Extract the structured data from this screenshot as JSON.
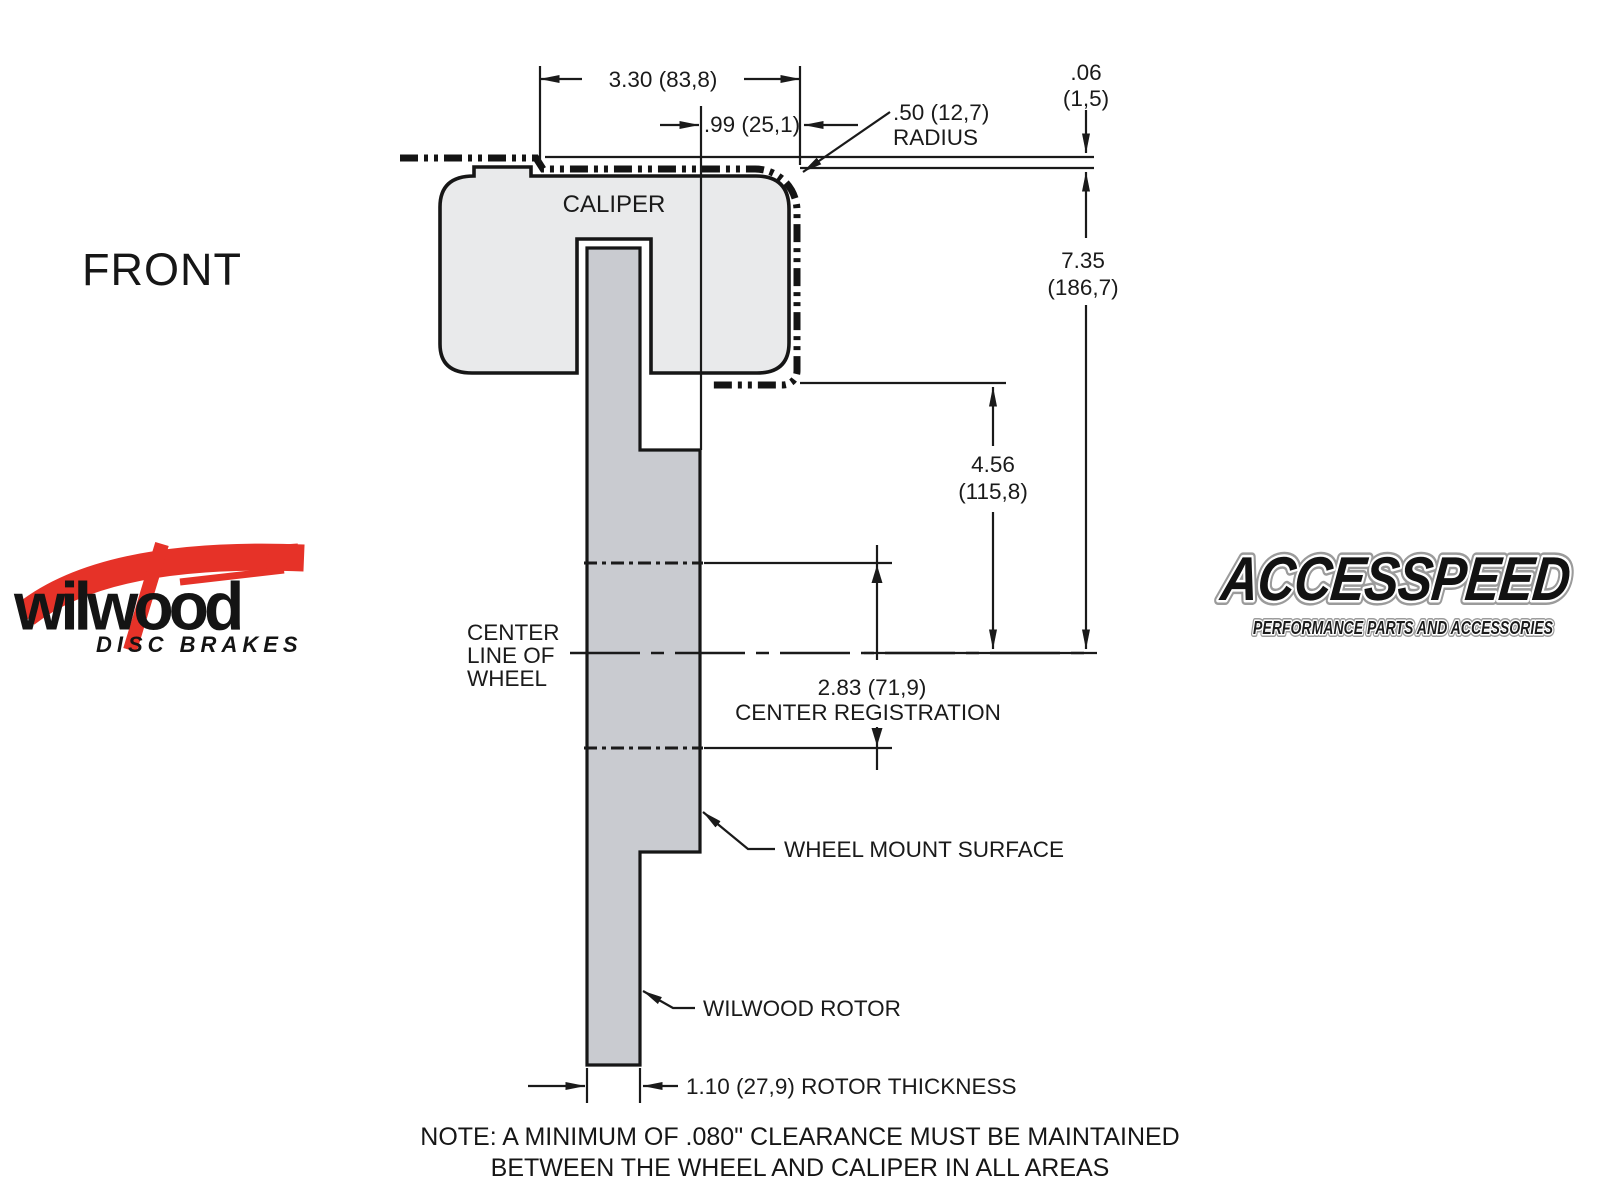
{
  "view_label": "FRONT",
  "caliper_label": "CALIPER",
  "dimensions": {
    "overall_width": {
      "text": "3.30 (83,8)"
    },
    "mount_to_wheel_bend": {
      "text": ".99 (25,1)"
    },
    "corner_radius": {
      "line1": ".50 (12,7)",
      "line2": "RADIUS"
    },
    "wheel_clearance": {
      "in": ".06",
      "mm": "(1,5)"
    },
    "overall_height": {
      "in": "7.35",
      "mm": "(186,7)"
    },
    "caliper_to_centerline": {
      "in": "4.56",
      "mm": "(115,8)"
    },
    "center_registration": {
      "value": "2.83 (71,9)",
      "label": "CENTER REGISTRATION"
    },
    "rotor_thickness": {
      "text": "1.10 (27,9) ROTOR THICKNESS"
    }
  },
  "labels": {
    "centerline": [
      "CENTER",
      "LINE OF",
      "WHEEL"
    ],
    "wheel_mount_surface": "WHEEL MOUNT SURFACE",
    "wilwood_rotor": "WILWOOD ROTOR"
  },
  "note": {
    "line1": "NOTE: A MINIMUM OF .080\" CLEARANCE MUST BE MAINTAINED",
    "line2": "BETWEEN THE WHEEL AND CALIPER IN ALL AREAS"
  },
  "logos": {
    "wilwood": {
      "name": "wilwood",
      "tagline": "DISC BRAKES",
      "brand_red": "#e63228",
      "ink": "#141414"
    },
    "accesspeed": {
      "name": "ACCESSPEED",
      "tagline": "PERFORMANCE PARTS AND ACCESSORIES"
    }
  },
  "colors": {
    "ink": "#1a1a1a",
    "caliper_fill": "#e9eaeb",
    "rotor_fill": "#c9cbd0",
    "background": "#ffffff"
  }
}
